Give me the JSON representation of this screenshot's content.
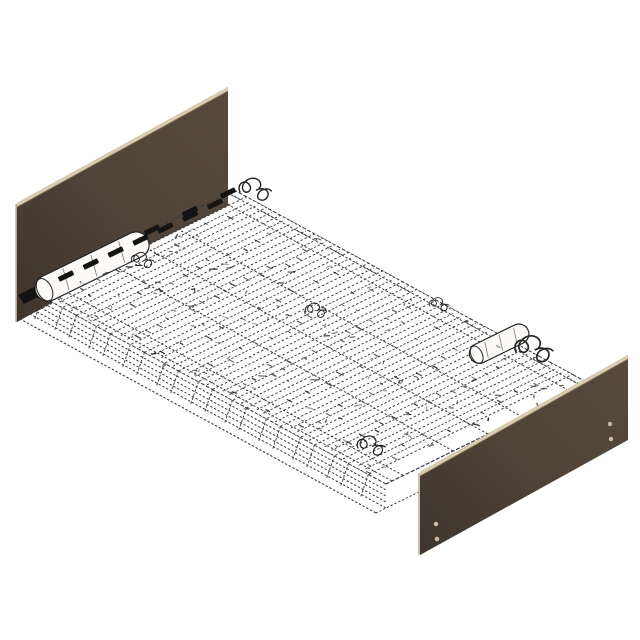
{
  "diagram": {
    "subject": "bed-frame-isometric-technical-drawing",
    "background": "#ffffff",
    "colors": {
      "panel": "#57493d",
      "panel_shadow": "#3f352d",
      "panel_edge_light": "#dbcbb0",
      "panel_edge_dark": "#8a7a62",
      "panel_side_light": "#b5a68e",
      "hidden_line": "#3d3d3d",
      "solid_line": "#242424",
      "dark_mark": "#141414",
      "hole_fill": "#cbbb9f",
      "slat_fill": "#ffffff",
      "roller_fill": "#fbfaf7"
    },
    "parts": {
      "headboard": {
        "label": "headboard-panel",
        "hole_count": 0
      },
      "footboard": {
        "label": "footboard-panel",
        "hole_count": 4
      },
      "base": {
        "label": "slatted-bed-base",
        "line_style": "hidden-dashed",
        "slat_count": 10,
        "roller_count": 2
      }
    },
    "geometry": {
      "base_corners": {
        "A": [
          30,
          290
        ],
        "B": [
          234,
          190
        ],
        "C": [
          590,
          384
        ],
        "D": [
          386,
          484
        ]
      },
      "depth_offset": [
        -10,
        29
      ],
      "side_offsets": [
        6,
        12,
        18,
        24
      ],
      "headboard_pts": "17,203 228,87 228,206 17,322",
      "headboard_top_strip": "17,203 228,87 228,91 17,207",
      "footboard_pts": "420,472 628,355 628,440 420,555",
      "footboard_top_strip": "420,472 628,355 628,359 420,476",
      "footboard_holes": [
        [
          436,
          524
        ],
        [
          437,
          539
        ],
        [
          610,
          424
        ],
        [
          611,
          439
        ]
      ],
      "slats": {
        "count": 10,
        "t_start": 0.035,
        "pitch": 0.0955,
        "thickness": 0.056
      },
      "long_lines": [
        0.03,
        0.085,
        0.33,
        0.5,
        0.67,
        0.915,
        0.97
      ],
      "mark_rows": [
        {
          "from": [
            66,
            276
          ],
          "to": [
            215,
            204
          ],
          "count": 7
        },
        {
          "from": [
            152,
            230
          ],
          "to": [
            228,
            193
          ],
          "count": 3
        }
      ],
      "rollers": [
        {
          "x": 40,
          "y": 292,
          "len": 124,
          "r": 13
        },
        {
          "x": 474,
          "y": 356,
          "len": 64,
          "r": 10
        }
      ],
      "bracket_pts": "18,295 56,276 62,285 24,304",
      "curls": [
        {
          "x": 240,
          "y": 192,
          "s": 1.15
        },
        {
          "x": 516,
          "y": 352,
          "s": 1.35
        },
        {
          "x": 358,
          "y": 448,
          "s": 1.0
        },
        {
          "x": 132,
          "y": 262,
          "s": 0.8
        },
        {
          "x": 306,
          "y": 312,
          "s": 0.75
        },
        {
          "x": 430,
          "y": 306,
          "s": 0.7
        }
      ],
      "iso_angle_deg": -26.1
    }
  }
}
